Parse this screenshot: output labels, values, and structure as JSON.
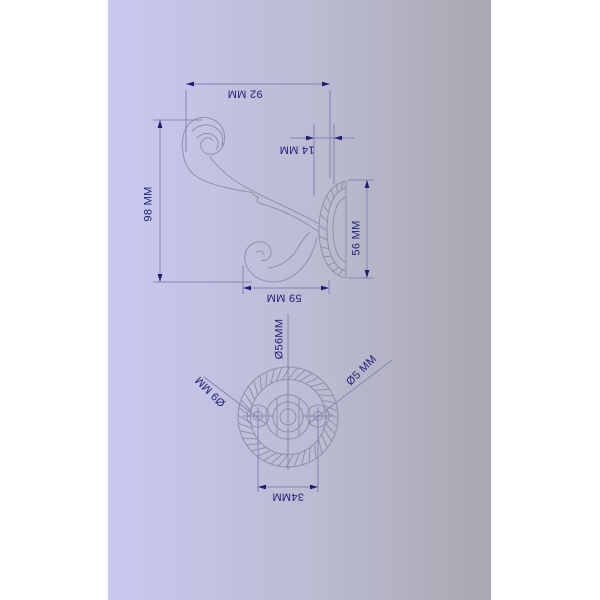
{
  "colors": {
    "bg_left": "#c9c9f1",
    "bg_mid": "#bbbbd2",
    "bg_right": "#a8a8b0",
    "margin": "#ffffff",
    "drawing_line": "#9191a9",
    "dim_line": "#8585b2",
    "accent_navy": "#1e1e78"
  },
  "side_view": {
    "width_label": "92 MM",
    "plate_depth_label": "14 MM",
    "height_label": "98 MM",
    "plate_diameter_label": "56 MM",
    "projection_label": "59 MM"
  },
  "front_view": {
    "backplate_diameter_label": "Ø56MM",
    "hole_counterbore_label": "Ø9 MM",
    "screw_hole_label": "Ø5 MM",
    "hole_spacing_label": "34MM"
  }
}
